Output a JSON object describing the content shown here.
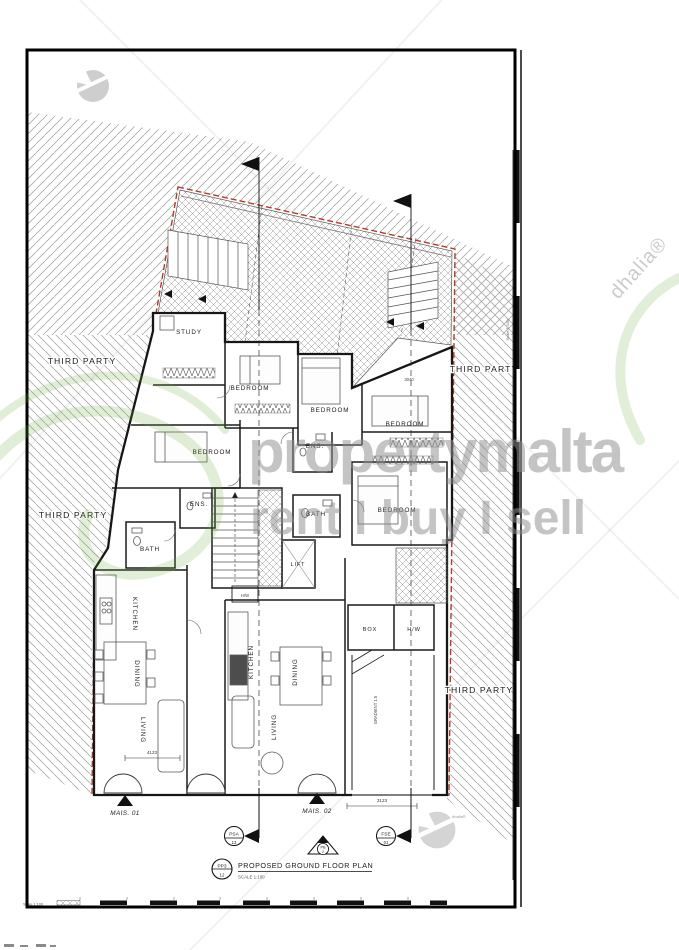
{
  "watermarks": {
    "brand": "propertymalta",
    "tagline": "rent I buy I sell",
    "agency_diagonal": "dhalia®",
    "agency_small": "dhalia®"
  },
  "annotations": {
    "third_party": "THIRD PARTY",
    "mais_01": "MAIS. 01",
    "mais_02": "MAIS. 02"
  },
  "rooms": {
    "study": "STUDY",
    "bedroom": "BEDROOM",
    "ensuite": "ENS.",
    "bath": "BATH",
    "lift": "LIFT",
    "hot_water": "H/W",
    "kitchen": "KITCHEN",
    "dining": "DINING",
    "living": "LIVING",
    "box": "BOX",
    "ramp_gradient": "GRADIENT 1:5"
  },
  "dimensions": {
    "front_mid": "3123",
    "living_left": "4123",
    "bedroom_right": "3040"
  },
  "markers": {
    "psa": {
      "code": "PSA",
      "sheet": "13"
    },
    "fse": {
      "code": "FSE",
      "sheet": "01"
    },
    "pb": {
      "code": "PB",
      "sheet": "2"
    },
    "plan": {
      "code": "PP3",
      "sheet": "12"
    }
  },
  "titleblock": {
    "title": "PROPOSED GROUND FLOOR PLAN",
    "scale": "SCALE 1:100",
    "ruler_note": "Scale 1:100"
  }
}
